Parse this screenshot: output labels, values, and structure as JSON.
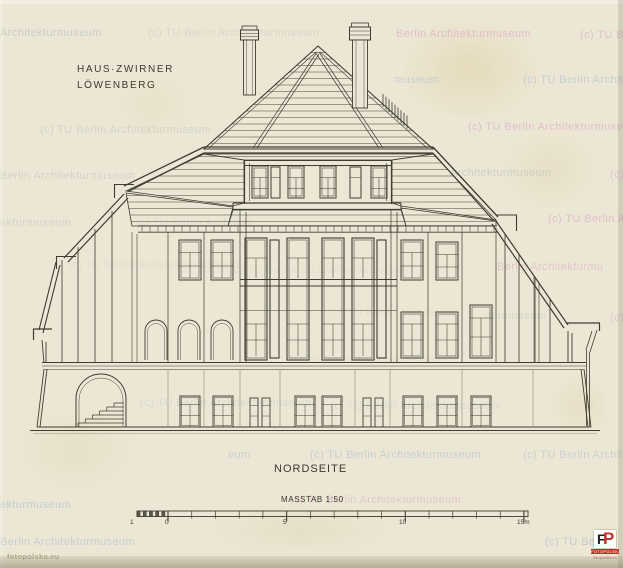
{
  "page": {
    "background": "#ece7d4",
    "ink": "#3f3c32",
    "bottom_edge": "#c9c2ab"
  },
  "annotations": {
    "title_line1": "HAUS·ZWIRNER",
    "title_line2": "LÖWENBERG",
    "caption": "NORDSEITE",
    "scale_text": "MASSTAB 1:50"
  },
  "scale_bar": {
    "unit_labels": [
      {
        "text": "1",
        "x": 130
      },
      {
        "text": "0",
        "x": 165
      },
      {
        "text": "5",
        "x": 283
      },
      {
        "text": "10",
        "x": 399
      },
      {
        "text": "15m",
        "x": 517
      }
    ]
  },
  "watermarks": [
    {
      "text": "Architekturmuseum",
      "x": 0,
      "y": 27,
      "tone": "gray",
      "opacity": 0.85
    },
    {
      "text": "(c) TU Berlin Architekturmuseum",
      "x": 148,
      "y": 27,
      "tone": "gray",
      "opacity": 0.5
    },
    {
      "text": "Berlin Architekturmuseum",
      "x": 396,
      "y": 28,
      "tone": "pink",
      "opacity": 0.6
    },
    {
      "text": "(c) TU Be",
      "x": 580,
      "y": 29,
      "tone": "pink",
      "opacity": 0.55
    },
    {
      "text": "museum",
      "x": 394,
      "y": 74,
      "tone": "blue",
      "opacity": 0.5
    },
    {
      "text": "(c) TU Berlin Architek",
      "x": 523,
      "y": 74,
      "tone": "blue",
      "opacity": 0.55
    },
    {
      "text": "(c) TU Berlin Architekturmuseum",
      "x": 40,
      "y": 124,
      "tone": "gray",
      "opacity": 0.6
    },
    {
      "text": "(c) TU Berlin Architekturmuseum",
      "x": 468,
      "y": 121,
      "tone": "pink",
      "opacity": 0.6
    },
    {
      "text": "Berlin Architekturmuseum",
      "x": 0,
      "y": 170,
      "tone": "gray",
      "opacity": 0.6
    },
    {
      "text": "Architekturmuseum",
      "x": 450,
      "y": 167,
      "tone": "gray",
      "opacity": 0.7
    },
    {
      "text": "(c)",
      "x": 610,
      "y": 169,
      "tone": "pink",
      "opacity": 0.5
    },
    {
      "text": "ekturmuseum",
      "x": 0,
      "y": 217,
      "tone": "gray",
      "opacity": 0.6
    },
    {
      "text": "(c) TU Berlin Architekt",
      "x": 136,
      "y": 217,
      "tone": "gray",
      "opacity": 0.35
    },
    {
      "text": "(c) TU Berlin Arc",
      "x": 548,
      "y": 213,
      "tone": "pink",
      "opacity": 0.6
    },
    {
      "text": "(c) TU Berlin Architekturmuseum",
      "x": 68,
      "y": 259,
      "tone": "gray",
      "opacity": 0.3
    },
    {
      "text": "Berlin Architekturmu",
      "x": 497,
      "y": 261,
      "tone": "pink",
      "opacity": 0.5
    },
    {
      "text": "(c) TU Berlin Architekturmuseum",
      "x": 230,
      "y": 264,
      "tone": "gray",
      "opacity": 0.22
    },
    {
      "text": "turmuseum",
      "x": 488,
      "y": 310,
      "tone": "gray",
      "opacity": 0.55
    },
    {
      "text": "(c)",
      "x": 610,
      "y": 312,
      "tone": "pink",
      "opacity": 0.5
    },
    {
      "text": "(c) TU Berlin Architektur",
      "x": 330,
      "y": 307,
      "tone": "gray",
      "opacity": 0.22
    },
    {
      "text": "(c) TU Berlin Architekturmuseum",
      "x": 270,
      "y": 354,
      "tone": "gray",
      "opacity": 0.25
    },
    {
      "text": "(c) TU Berlin Architekturmuseum",
      "x": 140,
      "y": 397,
      "tone": "blue",
      "opacity": 0.3
    },
    {
      "text": "(c) TU Berlin Architekturmuseum",
      "x": 330,
      "y": 400,
      "tone": "blue",
      "opacity": 0.25
    },
    {
      "text": "eum",
      "x": 228,
      "y": 449,
      "tone": "blue",
      "opacity": 0.5
    },
    {
      "text": "(c) TU Berlin Architekturmuseum",
      "x": 310,
      "y": 449,
      "tone": "blue",
      "opacity": 0.55
    },
    {
      "text": "(c) TU Berlin Archite",
      "x": 523,
      "y": 449,
      "tone": "blue",
      "opacity": 0.5
    },
    {
      "text": "ekturmuseum",
      "x": 0,
      "y": 499,
      "tone": "blue",
      "opacity": 0.6
    },
    {
      "text": "(c) TU Berlin Architekturmuseum",
      "x": 290,
      "y": 494,
      "tone": "pink",
      "opacity": 0.5
    },
    {
      "text": "Berlin Architekturmuseum",
      "x": 0,
      "y": 536,
      "tone": "blue",
      "opacity": 0.55
    },
    {
      "text": "(c) TU Berl",
      "x": 545,
      "y": 536,
      "tone": "blue",
      "opacity": 0.6
    }
  ],
  "branding": {
    "site_credit": "fotopolska.eu",
    "logo": {
      "letter_f": "F",
      "letter_p": "P",
      "band": "FOTOPOLSKA",
      "sub": "fotopolska.eu",
      "red": "#c23128"
    }
  }
}
